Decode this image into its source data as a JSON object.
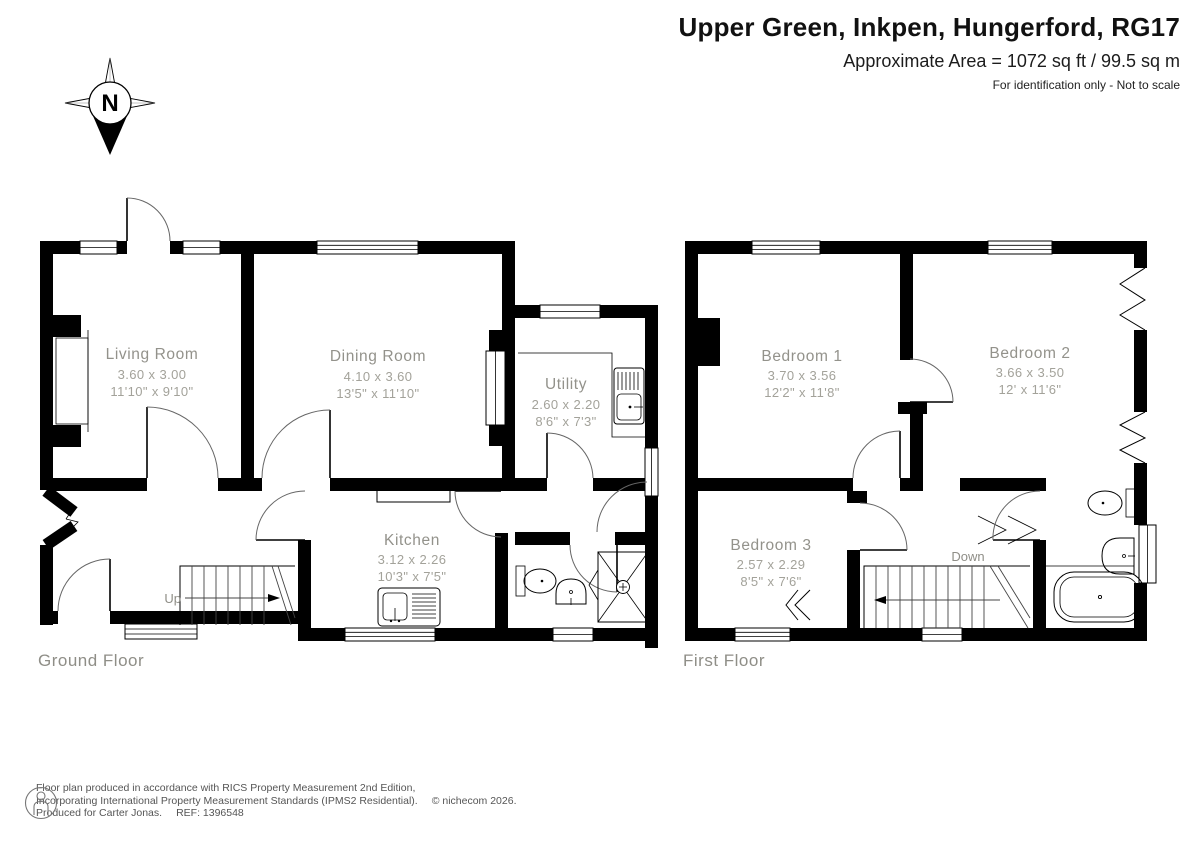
{
  "header": {
    "title": "Upper Green, Inkpen, Hungerford, RG17",
    "area": "Approximate Area = 1072 sq ft / 99.5 sq m",
    "disclaimer": "For identification only - Not to scale"
  },
  "compass": {
    "label": "N"
  },
  "floors": {
    "ground": {
      "label": "Ground Floor",
      "stairs_label": "Up",
      "rooms": {
        "living": {
          "name": "Living Room",
          "metric": "3.60 x 3.00",
          "imperial": "11'10\" x 9'10\""
        },
        "dining": {
          "name": "Dining Room",
          "metric": "4.10 x 3.60",
          "imperial": "13'5\" x 11'10\""
        },
        "utility": {
          "name": "Utility",
          "metric": "2.60 x 2.20",
          "imperial": "8'6\" x 7'3\""
        },
        "kitchen": {
          "name": "Kitchen",
          "metric": "3.12 x 2.26",
          "imperial": "10'3\" x 7'5\""
        }
      }
    },
    "first": {
      "label": "First Floor",
      "stairs_label": "Down",
      "rooms": {
        "bedroom1": {
          "name": "Bedroom 1",
          "metric": "3.70 x 3.56",
          "imperial": "12'2\" x 11'8\""
        },
        "bedroom2": {
          "name": "Bedroom 2",
          "metric": "3.66 x 3.50",
          "imperial": "12' x 11'6\""
        },
        "bedroom3": {
          "name": "Bedroom 3",
          "metric": "2.57 x 2.29",
          "imperial": "8'5\" x 7'6\""
        }
      }
    }
  },
  "footer": {
    "line1": "Floor plan produced in accordance with RICS Property Measurement 2nd Edition,",
    "line2": "Incorporating International Property Measurement Standards (IPMS2 Residential).",
    "copyright": "© nichecom 2026.",
    "line3": "Produced for Carter Jonas.",
    "ref": "REF: 1396548"
  },
  "colors": {
    "wall": "#000000",
    "label_gray": "#93928b",
    "dim_gray": "#a3a29a"
  }
}
